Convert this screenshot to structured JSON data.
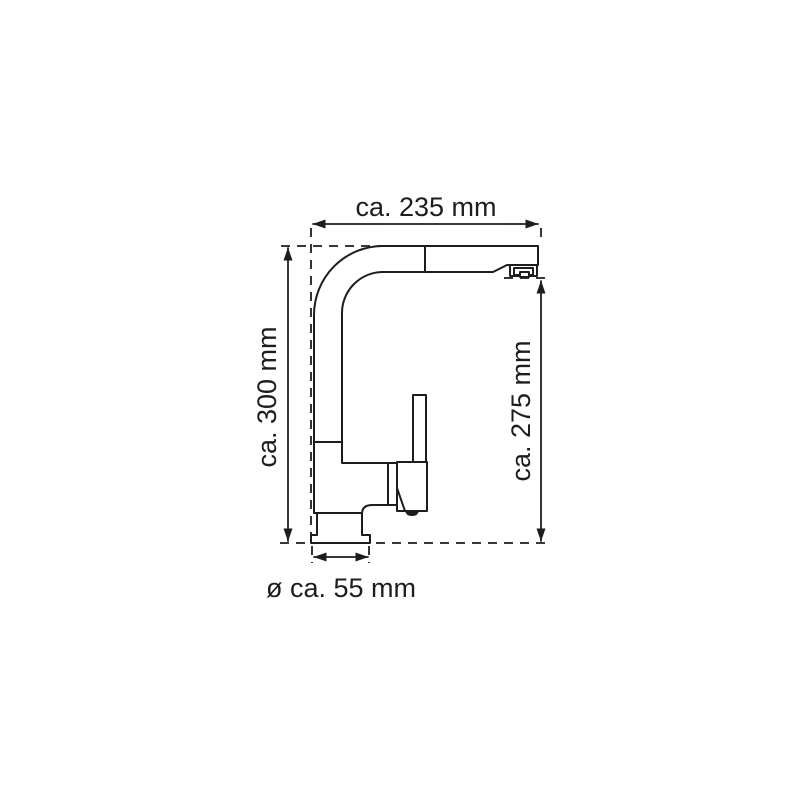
{
  "diagram": {
    "labels": {
      "top_width": "ca. 235 mm",
      "left_height": "ca. 300 mm",
      "right_height": "ca. 275 mm",
      "base_diameter": "ø ca. 55 mm"
    },
    "colors": {
      "line": "#1d1d1b",
      "background": "#ffffff"
    }
  }
}
